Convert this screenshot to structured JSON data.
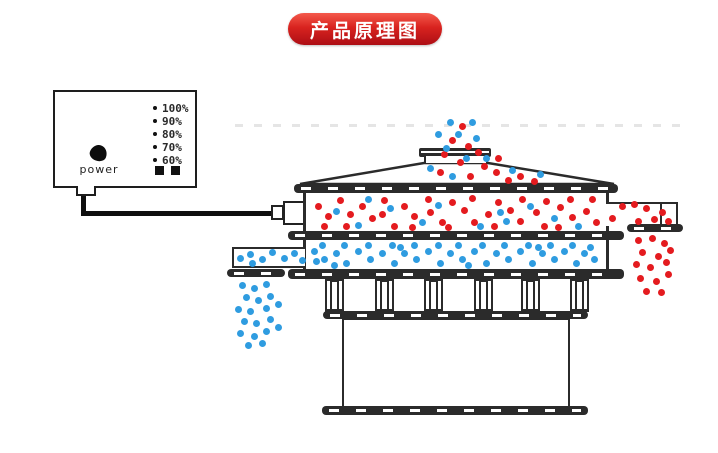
{
  "banner": {
    "label": "产品原理图"
  },
  "control_box": {
    "power_label": "power",
    "levels": [
      "100%",
      "90%",
      "80%",
      "70%",
      "60%"
    ]
  },
  "colors": {
    "red": "#e41b1f",
    "blue": "#2f9ce0",
    "line": "#2b2b2b",
    "banner_top": "#f4594b",
    "banner_mid": "#d8231f",
    "banner_bottom": "#ad0e15",
    "banner_text": "#ffffff"
  },
  "particles": {
    "feed": {
      "red": [
        [
          462,
          126
        ],
        [
          452,
          140
        ],
        [
          468,
          146
        ],
        [
          444,
          154
        ],
        [
          478,
          152
        ],
        [
          460,
          162
        ],
        [
          484,
          166
        ],
        [
          440,
          172
        ],
        [
          470,
          176
        ],
        [
          496,
          172
        ],
        [
          508,
          180
        ],
        [
          520,
          176
        ],
        [
          534,
          181
        ],
        [
          498,
          158
        ]
      ],
      "blue": [
        [
          450,
          122
        ],
        [
          472,
          122
        ],
        [
          438,
          134
        ],
        [
          458,
          134
        ],
        [
          476,
          138
        ],
        [
          446,
          148
        ],
        [
          466,
          158
        ],
        [
          430,
          168
        ],
        [
          452,
          176
        ],
        [
          486,
          158
        ],
        [
          512,
          170
        ],
        [
          540,
          174
        ]
      ]
    },
    "top_deck": {
      "red": [
        [
          318,
          206
        ],
        [
          328,
          216
        ],
        [
          324,
          226
        ],
        [
          340,
          200
        ],
        [
          350,
          214
        ],
        [
          346,
          226
        ],
        [
          362,
          206
        ],
        [
          372,
          218
        ],
        [
          384,
          200
        ],
        [
          382,
          214
        ],
        [
          394,
          226
        ],
        [
          404,
          206
        ],
        [
          414,
          216
        ],
        [
          412,
          227
        ],
        [
          428,
          199
        ],
        [
          430,
          212
        ],
        [
          442,
          222
        ],
        [
          452,
          202
        ],
        [
          448,
          227
        ],
        [
          464,
          210
        ],
        [
          472,
          198
        ],
        [
          474,
          222
        ],
        [
          488,
          214
        ],
        [
          498,
          202
        ],
        [
          494,
          226
        ],
        [
          510,
          210
        ],
        [
          522,
          199
        ],
        [
          520,
          221
        ],
        [
          536,
          212
        ],
        [
          546,
          201
        ],
        [
          544,
          226
        ],
        [
          560,
          207
        ],
        [
          572,
          217
        ],
        [
          570,
          199
        ],
        [
          586,
          211
        ],
        [
          596,
          222
        ],
        [
          592,
          199
        ],
        [
          558,
          227
        ]
      ],
      "blue": [
        [
          336,
          211
        ],
        [
          358,
          225
        ],
        [
          390,
          208
        ],
        [
          422,
          222
        ],
        [
          438,
          205
        ],
        [
          480,
          226
        ],
        [
          506,
          221
        ],
        [
          530,
          206
        ],
        [
          554,
          218
        ],
        [
          578,
          226
        ],
        [
          500,
          212
        ],
        [
          368,
          199
        ]
      ]
    },
    "right_channel": {
      "red": [
        [
          612,
          218
        ],
        [
          622,
          206
        ],
        [
          634,
          204
        ],
        [
          646,
          208
        ],
        [
          654,
          219
        ],
        [
          662,
          212
        ],
        [
          668,
          221
        ],
        [
          638,
          221
        ]
      ]
    },
    "right_fall": {
      "red": [
        [
          638,
          240
        ],
        [
          652,
          238
        ],
        [
          664,
          243
        ],
        [
          642,
          252
        ],
        [
          658,
          256
        ],
        [
          670,
          250
        ],
        [
          636,
          264
        ],
        [
          650,
          267
        ],
        [
          666,
          262
        ],
        [
          640,
          278
        ],
        [
          656,
          281
        ],
        [
          668,
          274
        ],
        [
          646,
          291
        ],
        [
          661,
          292
        ]
      ]
    },
    "lower_deck": {
      "blue": [
        [
          314,
          251
        ],
        [
          324,
          259
        ],
        [
          322,
          245
        ],
        [
          336,
          253
        ],
        [
          346,
          263
        ],
        [
          344,
          245
        ],
        [
          358,
          251
        ],
        [
          370,
          259
        ],
        [
          368,
          245
        ],
        [
          382,
          253
        ],
        [
          394,
          263
        ],
        [
          392,
          245
        ],
        [
          404,
          253
        ],
        [
          416,
          259
        ],
        [
          414,
          245
        ],
        [
          428,
          251
        ],
        [
          440,
          263
        ],
        [
          438,
          245
        ],
        [
          450,
          253
        ],
        [
          462,
          259
        ],
        [
          458,
          245
        ],
        [
          474,
          251
        ],
        [
          486,
          263
        ],
        [
          482,
          245
        ],
        [
          496,
          253
        ],
        [
          508,
          259
        ],
        [
          504,
          245
        ],
        [
          520,
          251
        ],
        [
          532,
          263
        ],
        [
          528,
          245
        ],
        [
          542,
          253
        ],
        [
          554,
          259
        ],
        [
          550,
          245
        ],
        [
          564,
          251
        ],
        [
          576,
          263
        ],
        [
          572,
          245
        ],
        [
          584,
          253
        ],
        [
          594,
          259
        ],
        [
          590,
          247
        ],
        [
          334,
          265
        ],
        [
          400,
          247
        ],
        [
          468,
          265
        ],
        [
          538,
          247
        ],
        [
          316,
          261
        ]
      ]
    },
    "left_channel": {
      "blue": [
        [
          240,
          258
        ],
        [
          250,
          254
        ],
        [
          262,
          259
        ],
        [
          272,
          252
        ],
        [
          284,
          258
        ],
        [
          294,
          253
        ],
        [
          302,
          260
        ],
        [
          252,
          263
        ]
      ]
    },
    "left_fall": {
      "blue": [
        [
          242,
          285
        ],
        [
          254,
          288
        ],
        [
          266,
          284
        ],
        [
          246,
          297
        ],
        [
          258,
          300
        ],
        [
          270,
          296
        ],
        [
          238,
          309
        ],
        [
          250,
          311
        ],
        [
          266,
          308
        ],
        [
          278,
          304
        ],
        [
          244,
          321
        ],
        [
          256,
          323
        ],
        [
          270,
          319
        ],
        [
          240,
          333
        ],
        [
          254,
          336
        ],
        [
          266,
          331
        ],
        [
          278,
          327
        ],
        [
          248,
          345
        ],
        [
          262,
          343
        ]
      ]
    }
  }
}
